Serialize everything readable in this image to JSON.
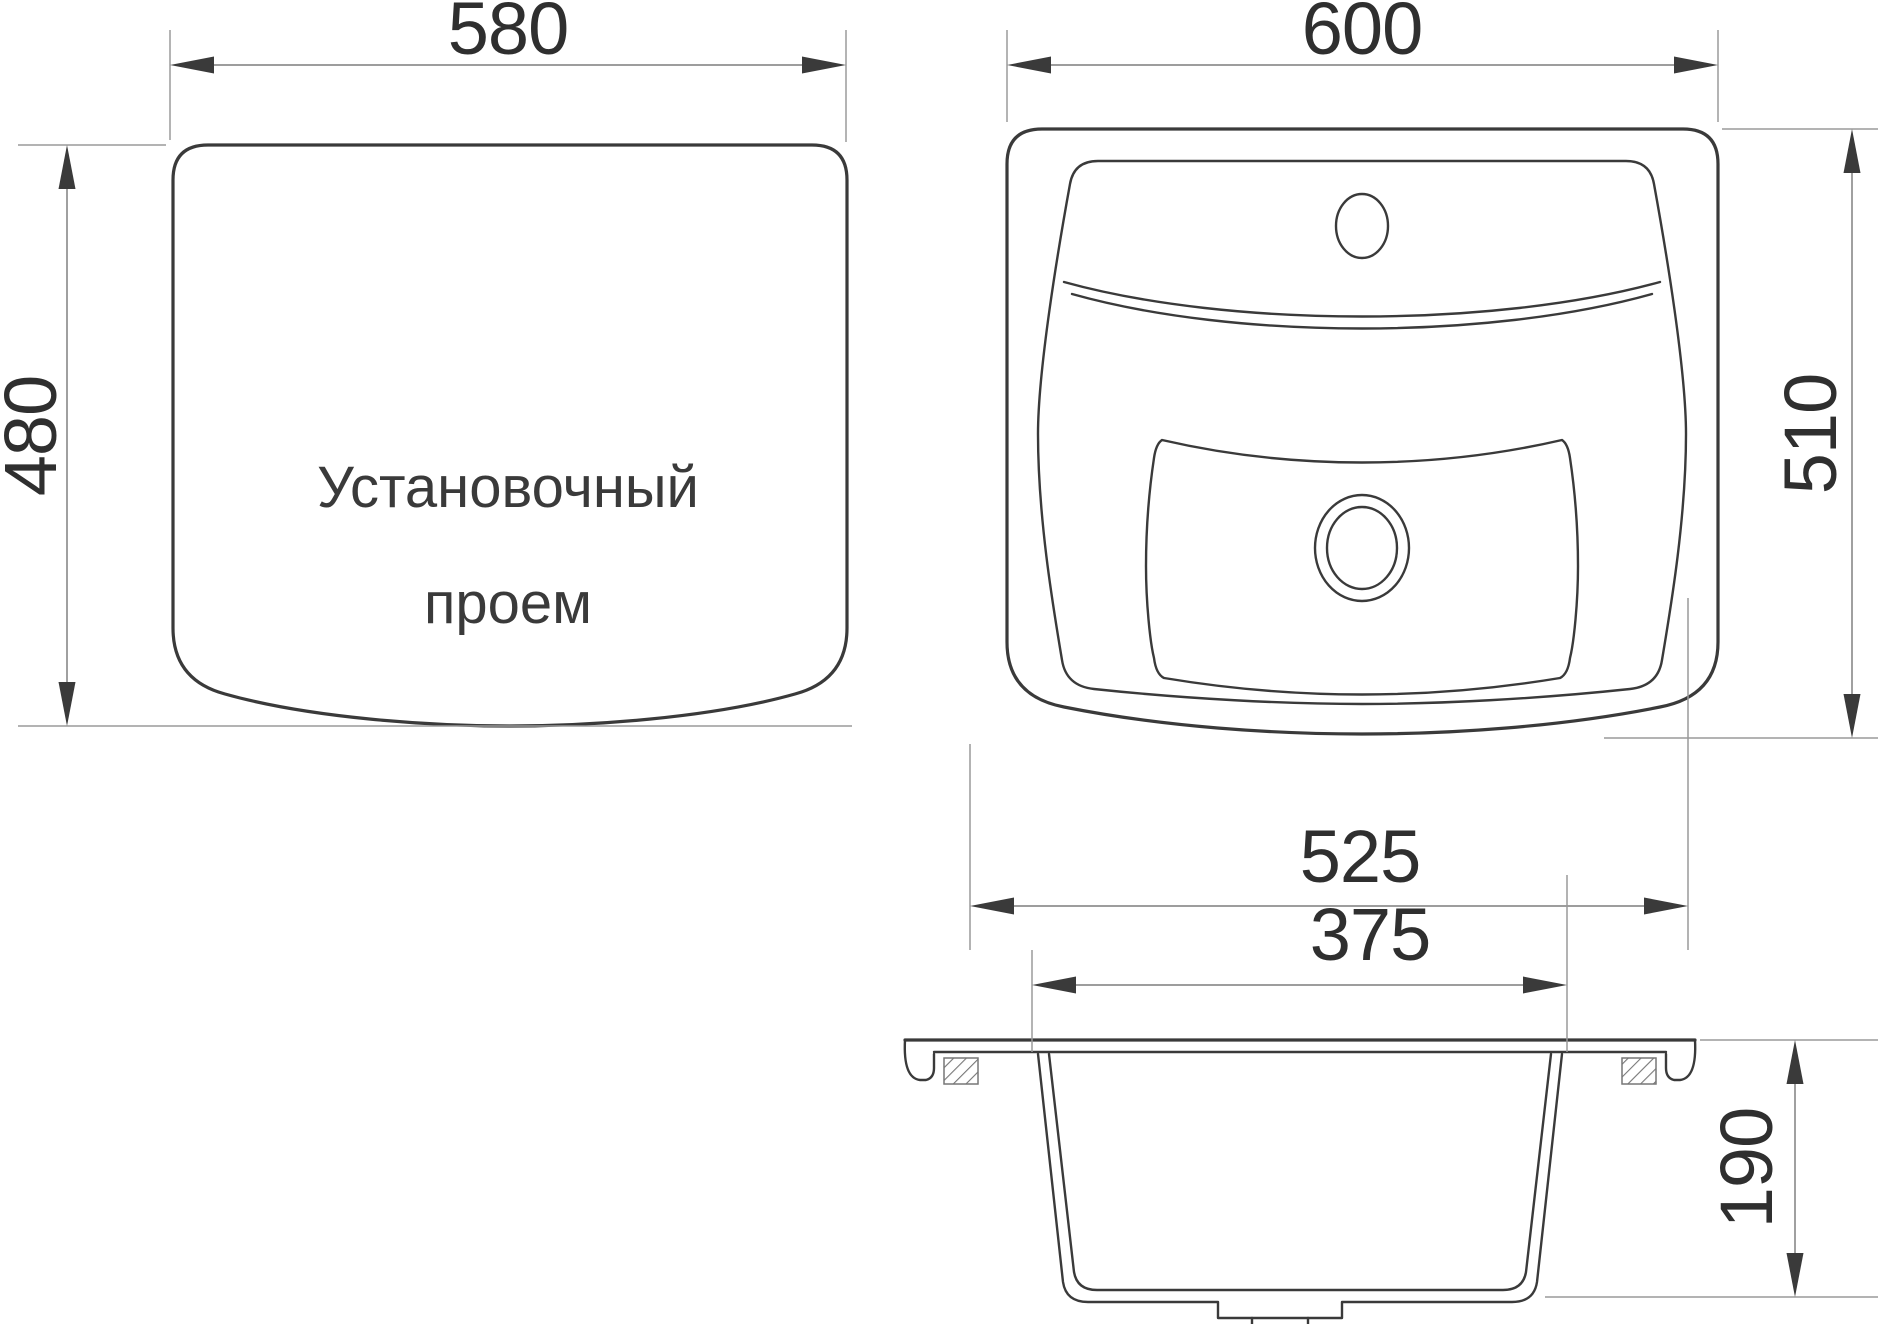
{
  "drawing": {
    "canvas": {
      "width": "1880",
      "height": "1324",
      "background": "#ffffff"
    },
    "colors": {
      "object_line": "#3a3a3a",
      "dimension_line": "#8f8f8f",
      "arrow_fill": "#3a3a3a",
      "text": "#2f2f2f",
      "hatch": "#777777"
    },
    "installation_opening": {
      "label_line1": "Установочный",
      "label_line2": "проем",
      "width_dim": "580",
      "height_dim": "480"
    },
    "sink_top_view": {
      "width_dim": "600",
      "height_dim": "510",
      "bottom_width_dim": "525"
    },
    "sink_section_view": {
      "bowl_width_dim": "375",
      "depth_dim": "190"
    }
  }
}
